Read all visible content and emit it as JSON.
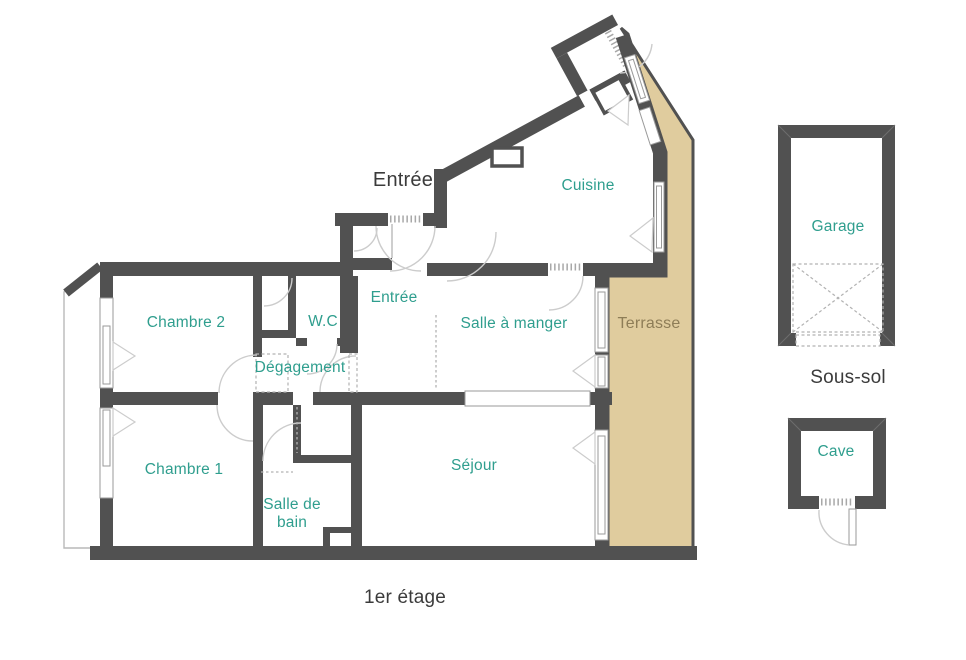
{
  "type": "floorplan",
  "floor": {
    "title": "1er étage",
    "exterior_entrance_label": "Entrée",
    "rooms": {
      "chambre2": "Chambre 2",
      "wc": "W.C",
      "entree": "Entrée",
      "salle_a_manger": "Salle à manger",
      "cuisine": "Cuisine",
      "degagement": "Dégagement",
      "chambre1": "Chambre 1",
      "salle_de_bain": "Salle de\nbain",
      "sejour": "Séjour",
      "terrasse": "Terrasse"
    }
  },
  "basement": {
    "title": "Sous-sol",
    "rooms": {
      "garage": "Garage",
      "cave": "Cave"
    }
  },
  "colors": {
    "wall": "#515151",
    "terrace": "#e0cc9e",
    "room_label": "#2f9e8e",
    "terrace_label": "#8e7d57",
    "annotation": "#3b3b3b",
    "line": "#cccccc",
    "window": "#9a9a9a",
    "dash": "#b2b2b2"
  }
}
